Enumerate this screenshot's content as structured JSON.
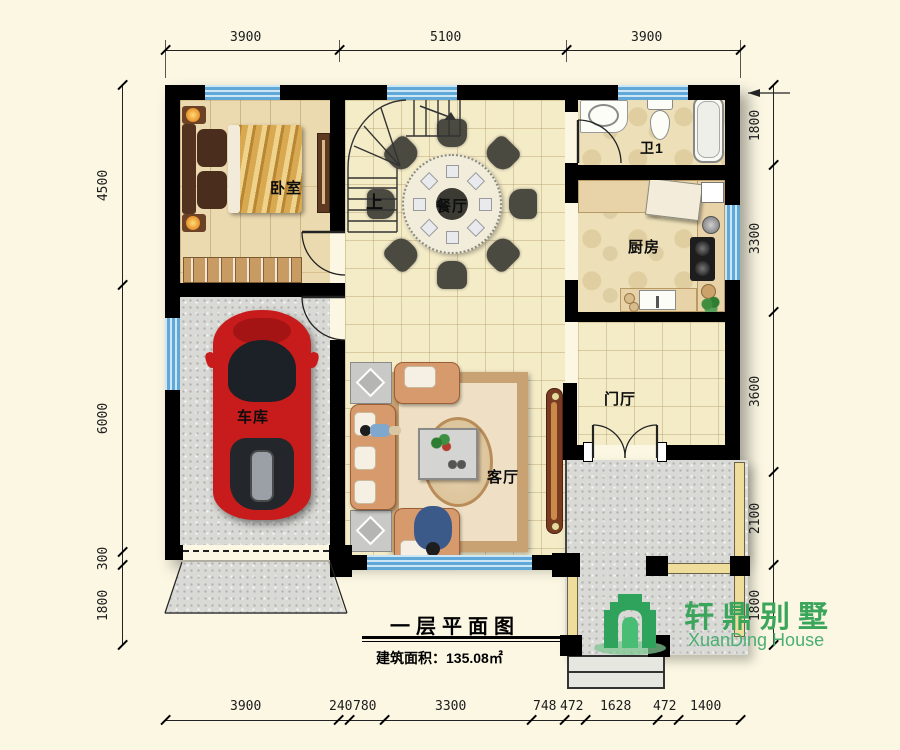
{
  "rooms": {
    "bedroom": "卧室",
    "dining": "餐厅",
    "bath": "卫1",
    "kitchen": "厨房",
    "garage": "车库",
    "living": "客厅",
    "foyer": "门厅",
    "stairs_up": "上"
  },
  "title": {
    "main": "一层平面图",
    "area": "建筑面积：135.08㎡"
  },
  "logo": {
    "cn": "轩鼎别墅",
    "en": "XuanDing House"
  },
  "dims": {
    "top": [
      "3900",
      "5100",
      "3900"
    ],
    "left": [
      "4500",
      "6000",
      "300",
      "1800"
    ],
    "right": [
      "1800",
      "3300",
      "3600",
      "2100",
      "1800"
    ],
    "bottom": [
      "3900",
      "240",
      "780",
      "3300",
      "748",
      "472",
      "1628",
      "472",
      "1400"
    ]
  },
  "colors": {
    "window_blue": "#5FA8D8",
    "logo_green": "#3CA55C",
    "wall_black": "#000000",
    "paper_cream": "#FBF7E3",
    "car_red": "#C81C1C"
  }
}
